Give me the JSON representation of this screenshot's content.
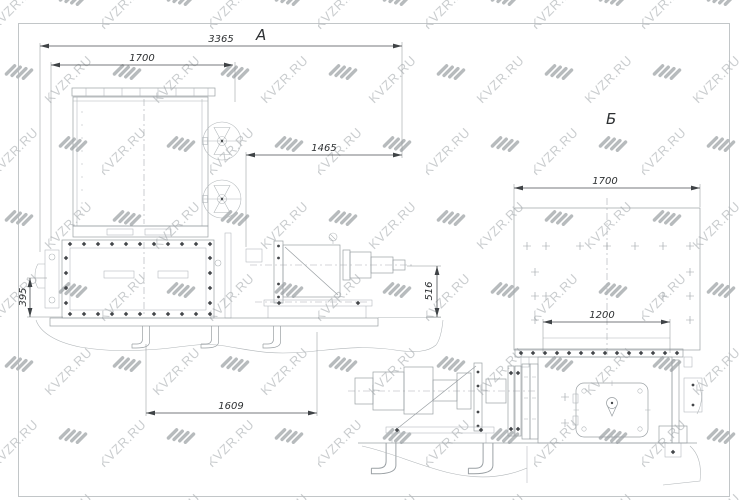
{
  "watermark": {
    "text": "KVZR.RU"
  },
  "colors": {
    "machine_line": "#9aa0a4",
    "dimension_line": "#4a4e51",
    "dimension_text": "#2d3032",
    "watermark_text": "#cacdcf",
    "watermark_icon": "#b7bbbd",
    "background": "#ffffff"
  },
  "views": {
    "a": {
      "label": "А",
      "dims": {
        "overall_width": "3365",
        "radiator_width": "1700",
        "coupling_offset": "1465",
        "left_height": "395",
        "base_span": "1609",
        "shaft_height": "516"
      }
    },
    "b": {
      "label": "Б",
      "dims": {
        "radiator_width": "1700",
        "base_span": "1200"
      }
    }
  }
}
